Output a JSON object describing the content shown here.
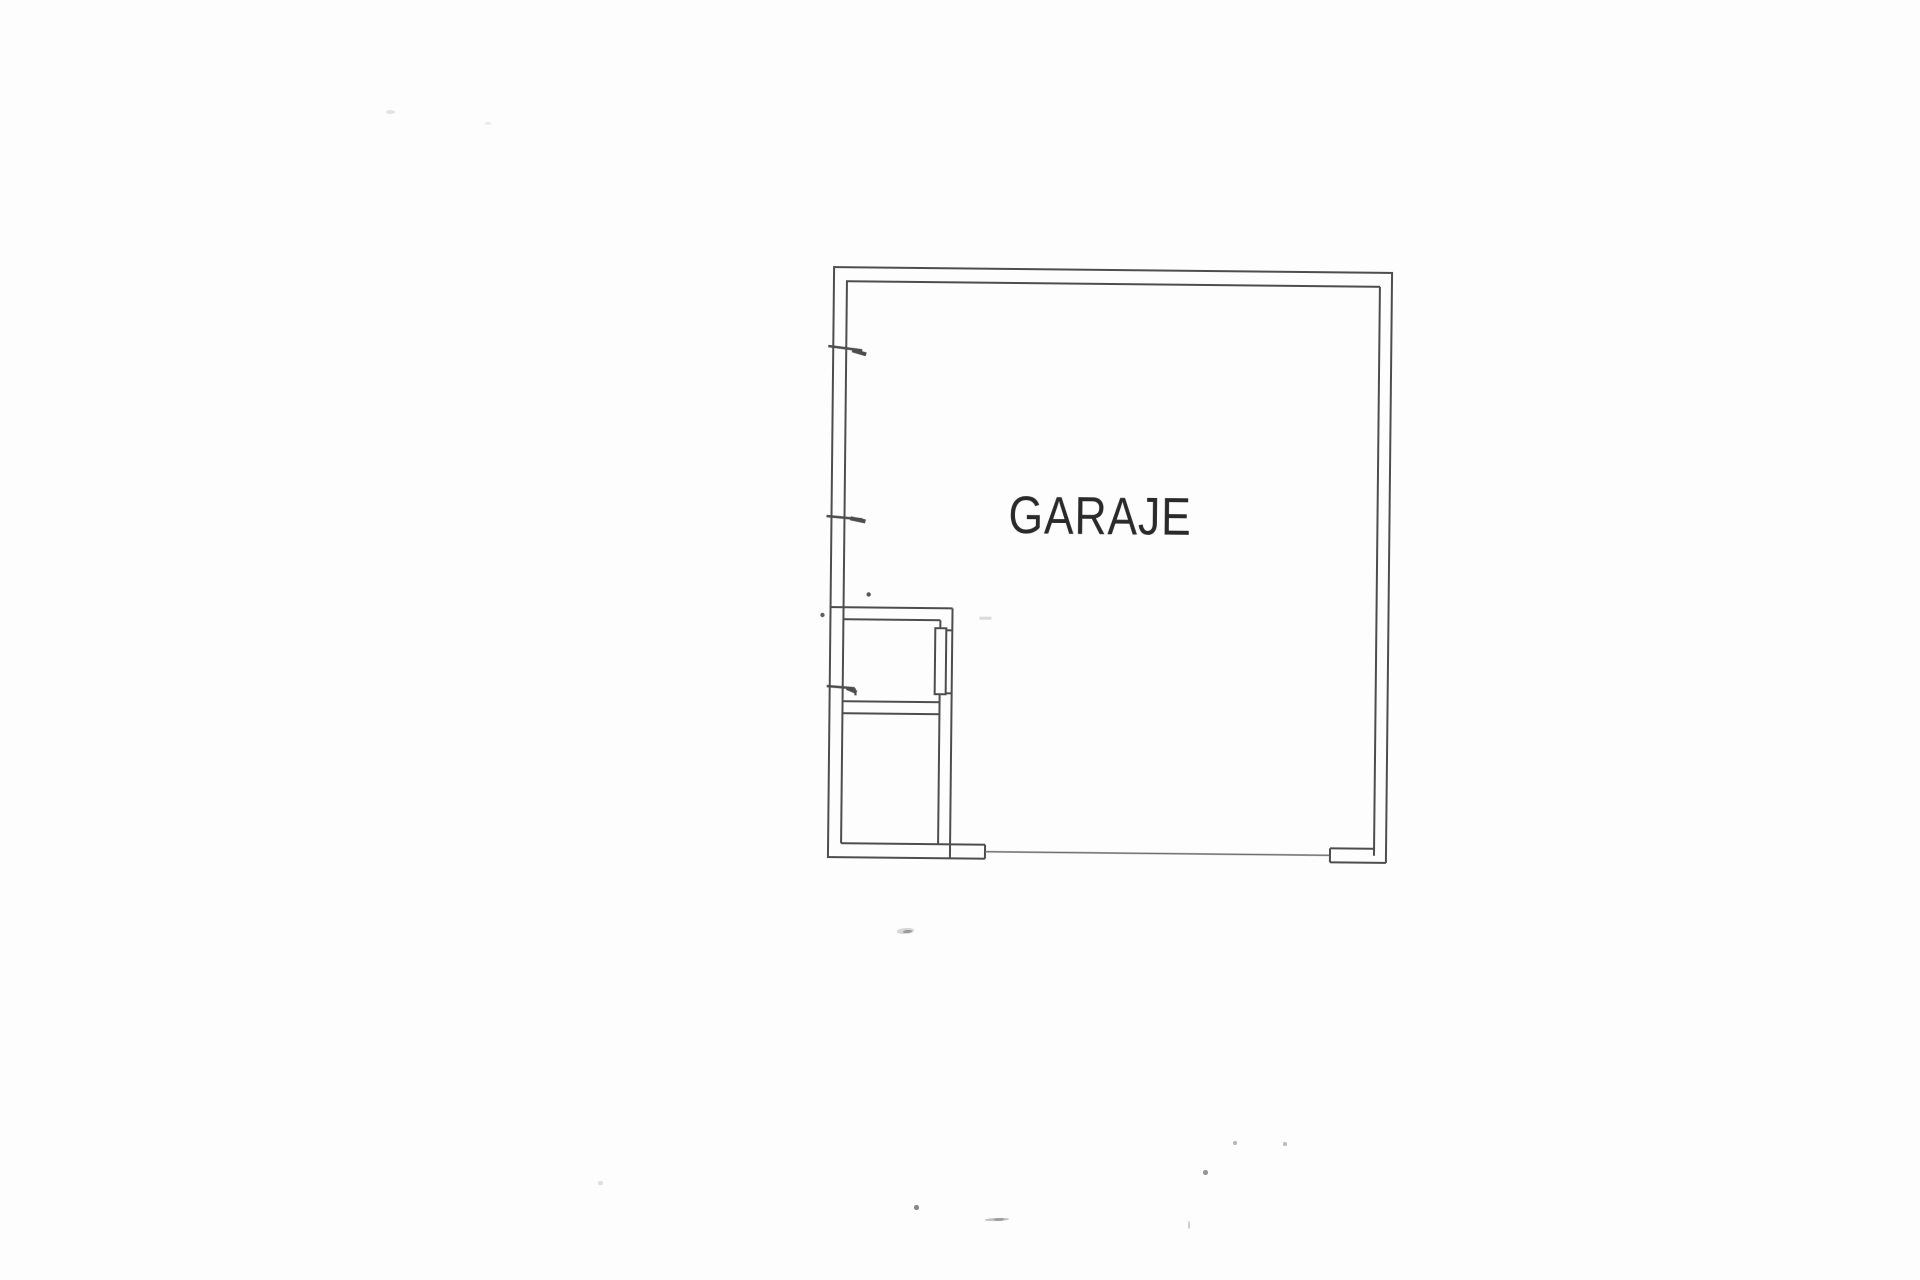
{
  "floor_plan": {
    "room_label": "GARAJE",
    "colors": {
      "background": "#fdfdfd",
      "wall_line": "#4d4d4d",
      "label_text": "#2a2a2a"
    }
  }
}
